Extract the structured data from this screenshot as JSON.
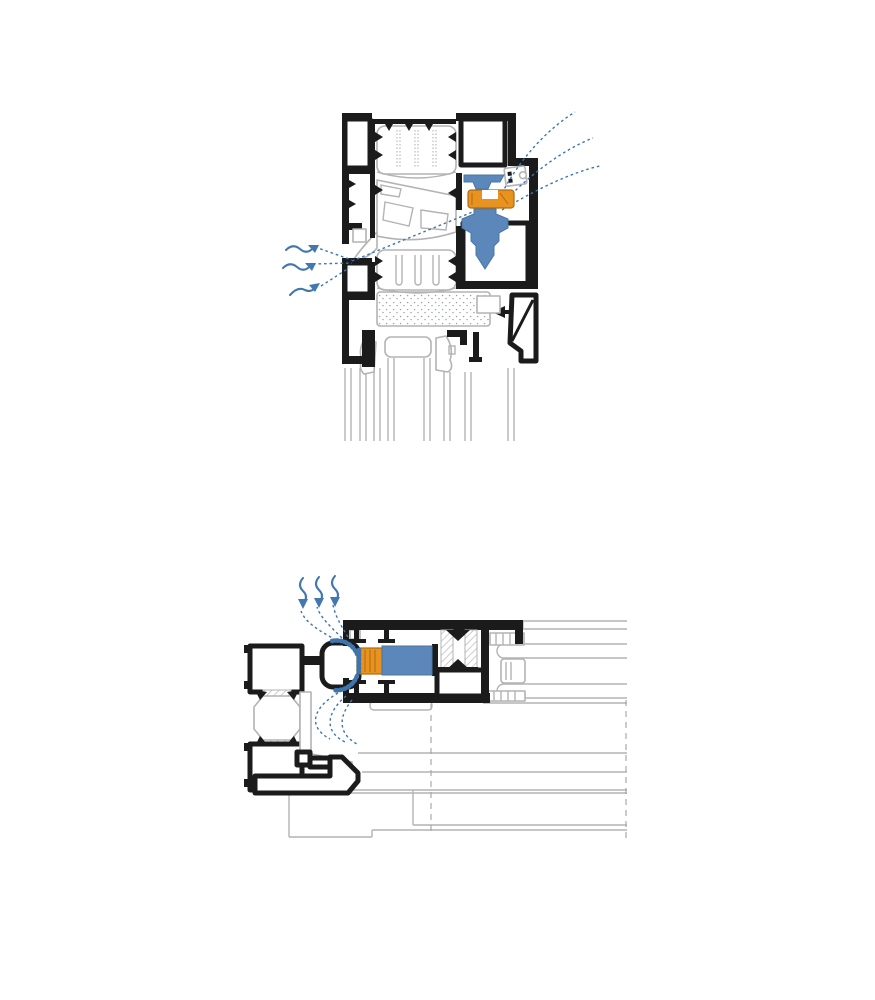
{
  "window": {
    "width": 875,
    "height": 1000,
    "background": "#ffffff"
  },
  "colors": {
    "bg": "#ffffff",
    "ink": "#1b1b1b",
    "profile-gray": "#b3b3b3",
    "hatch-gray": "#c4c4c4",
    "stipple-gray": "#9aa0a6",
    "component-blue": "#5b87ba",
    "component-blue-dark": "#4a76a6",
    "component-orange": "#e8931f",
    "component-orange-dark": "#b06a12",
    "flow-blue": "#3f74ad",
    "arrow-blue": "#4377b0",
    "dash-gray": "#9aa4ad"
  },
  "diagrams": {
    "top": {
      "name": "vertical-section-frame-vent",
      "aria_label": "Vertical cross-section of an aluminium window frame with a concealed ventilation valve: outside air enters through wavy arrows at the left, passes diagonally through the profile chambers and the blue valve with orange roller gasket, and exits as three dashed streamlines at the top right",
      "airflow": {
        "inlet_wavy_arrows": 3,
        "inlet_streamlines": 3,
        "outlet_streamlines": 3
      },
      "components": [
        "outer-frame-profile",
        "thermal-break-inserts",
        "vent-valve-body",
        "vent-valve-roller-gasket",
        "keeper-bracket",
        "insulation-foam-block",
        "glazing-unit",
        "glazing-bead"
      ]
    },
    "bottom": {
      "name": "horizontal-section-frame-vent",
      "aria_label": "Horizontal cross-section of an aluminium frame and sash with a ventilation insert: the air path curves around the rounded frame bulb past a brush seal, an orange brush block and a blue vent insert, exiting as three wavy arrows at the top",
      "airflow": {
        "outlet_wavy_arrows": 3,
        "streamlines_upper": 3,
        "streamlines_lower": 3
      },
      "components": [
        "frame-profile",
        "thermal-break-octagon",
        "frame-bulb",
        "brush-seal",
        "vent-insert-blue",
        "thermal-break-bars",
        "sash-profile",
        "glazing-unit",
        "sill-projection-lines"
      ]
    }
  }
}
